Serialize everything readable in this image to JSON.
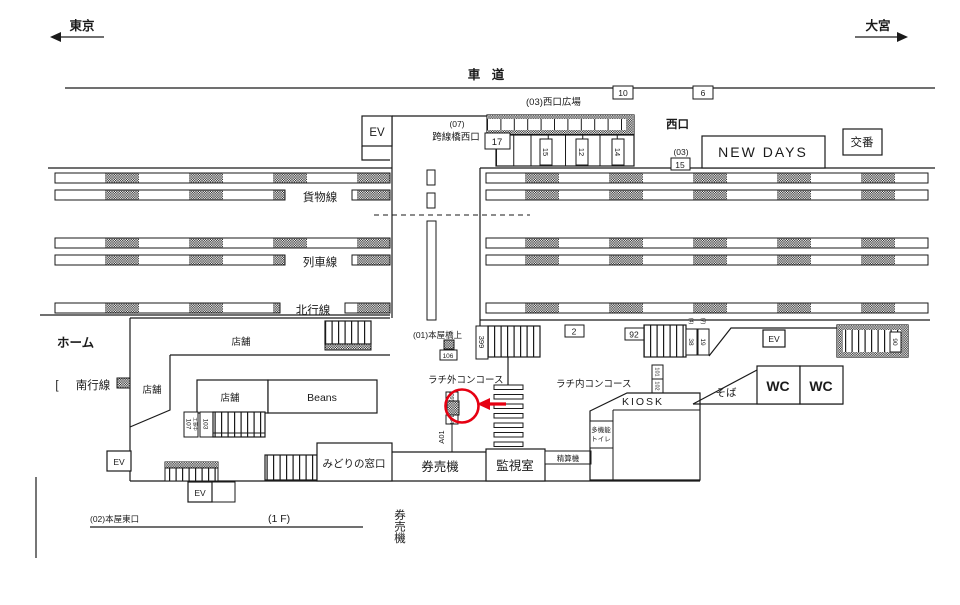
{
  "directions": {
    "left": "東京",
    "right": "大宮"
  },
  "road": {
    "label": "車 道",
    "marker10": "10",
    "marker6": "6"
  },
  "west": {
    "plaza": "(03)西口広場",
    "exit": "西口",
    "code": "(03)",
    "marker15": "15",
    "new_days": "NEW DAYS",
    "koban": "交番",
    "ev": "EV",
    "bridge_code": "(07)",
    "bridge_name": "跨線橋西口",
    "m17": "17",
    "s15": "15",
    "s12": "12",
    "s14": "14"
  },
  "tracks": {
    "platform": "ホーム",
    "freight": "貨物線",
    "train": "列車線",
    "north": "北行線",
    "south": "南行線",
    "south_bracket": "["
  },
  "center": {
    "bridge_label": "(01)本屋橋上",
    "m106": "106",
    "m399": "399",
    "concourse_out": "ラチ外コンコース",
    "m09": "(09)",
    "m104": "104",
    "a01": "A01"
  },
  "shops": {
    "shop_upper": "店舗",
    "shop_left": "店舗",
    "shop_lower": "店舗",
    "beans": "Beans",
    "m107": "107",
    "m107_note": "工事中",
    "m103": "103"
  },
  "south_area": {
    "midori": "みどりの窓口",
    "kenbaiki": "券売機",
    "kanshi": "監視室",
    "seisan": "精算機",
    "ev_a": "EV",
    "ev_b": "EV",
    "east_exit": "(02)本屋東口",
    "floor": "(1 F)",
    "kenbaiki_v": "券売機"
  },
  "east": {
    "concourse_in": "ラチ内コンコース",
    "m2": "2",
    "m92": "92",
    "m38": "38",
    "m19": "19",
    "n4": "(4)",
    "n7": "(7)",
    "m101": "101",
    "m102": "102",
    "m90": "90",
    "kiosk": "KIOSK",
    "soba": "そば",
    "wc1": "WC",
    "wc2": "WC",
    "ev": "EV",
    "toilet_l1": "多機能",
    "toilet_l2": "トイレ"
  }
}
